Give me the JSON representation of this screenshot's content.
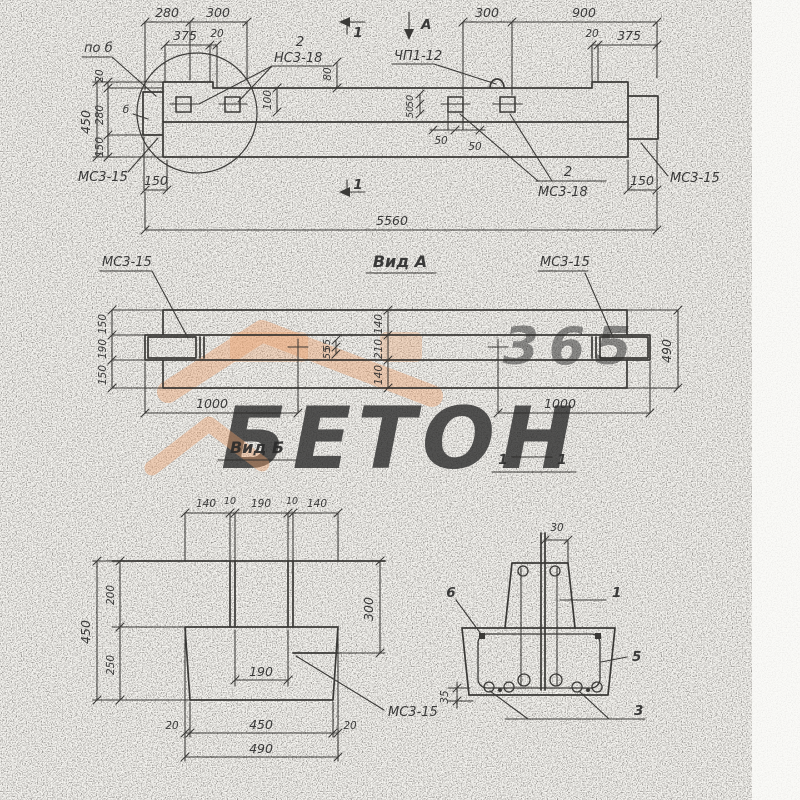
{
  "colors": {
    "paper": "#f6f5f1",
    "ink": "#2b2b2b",
    "watermark_orange": "#eba06b",
    "watermark_gray": "#dcdbd7"
  },
  "watermark": {
    "number": "365",
    "word": "БЕТОН"
  },
  "top_view": {
    "dim_280": "280",
    "dim_300_left": "300",
    "dim_375_left": "375",
    "dim_20_left": "20",
    "dim_300_right": "300",
    "dim_900": "900",
    "dim_20_right": "20",
    "dim_375_right": "375",
    "dim_v20": "20",
    "dim_v280": "280",
    "dim_v150": "150",
    "dim_v450": "450",
    "dim_80": "80",
    "dim_100": "100",
    "dim_50_a": "50",
    "dim_50_b": "50",
    "dim_50_c": "50",
    "dim_50_d": "50",
    "label_po_b": "по б",
    "label_b": "б",
    "label_ms3_15_left": "МС3-15",
    "dim_150_bottom_left": "150",
    "label_2_top": "2",
    "label_ns3_18": "НС3-18",
    "label_chp1_12": "ЧП1-12",
    "label_2_bottom": "2",
    "label_ms3_18": "МС3-18",
    "label_ms3_15_right": "МС3-15",
    "dim_150_bottom_right": "150",
    "dim_5560": "5560",
    "section_mark_top": "1",
    "section_mark_bottom": "1",
    "view_arrow_a": "А"
  },
  "view_a": {
    "title": "Вид А",
    "label_ms3_15_left": "МС3-15",
    "label_ms3_15_right": "МС3-15",
    "dim_left_150_top": "150",
    "dim_left_190": "190",
    "dim_left_150_bottom": "150",
    "dim_mid_140_top": "140",
    "dim_mid_210": "210",
    "dim_mid_140_bottom": "140",
    "dim_55_a": "55",
    "dim_55_b": "55",
    "dim_1000_left": "1000",
    "dim_1000_right": "1000",
    "dim_490": "490"
  },
  "view_b_title": "Вид Б",
  "section_1_1_mark": {
    "left": "1",
    "right": "1"
  },
  "section_b": {
    "dim_140_left": "140",
    "dim_10_left": "10",
    "dim_190_top": "190",
    "dim_10_right": "10",
    "dim_140_right": "140",
    "dim_200": "200",
    "dim_250": "250",
    "dim_450_left": "450",
    "dim_300": "300",
    "dim_190_inner": "190",
    "dim_20_left": "20",
    "dim_450_bottom": "450",
    "dim_20_right": "20",
    "dim_490": "490",
    "label_ms3_15": "МС3-15"
  },
  "section_1": {
    "dim_30": "30",
    "label_6": "6",
    "label_1": "1",
    "label_5": "5",
    "label_3": "3",
    "dim_35": "35"
  }
}
